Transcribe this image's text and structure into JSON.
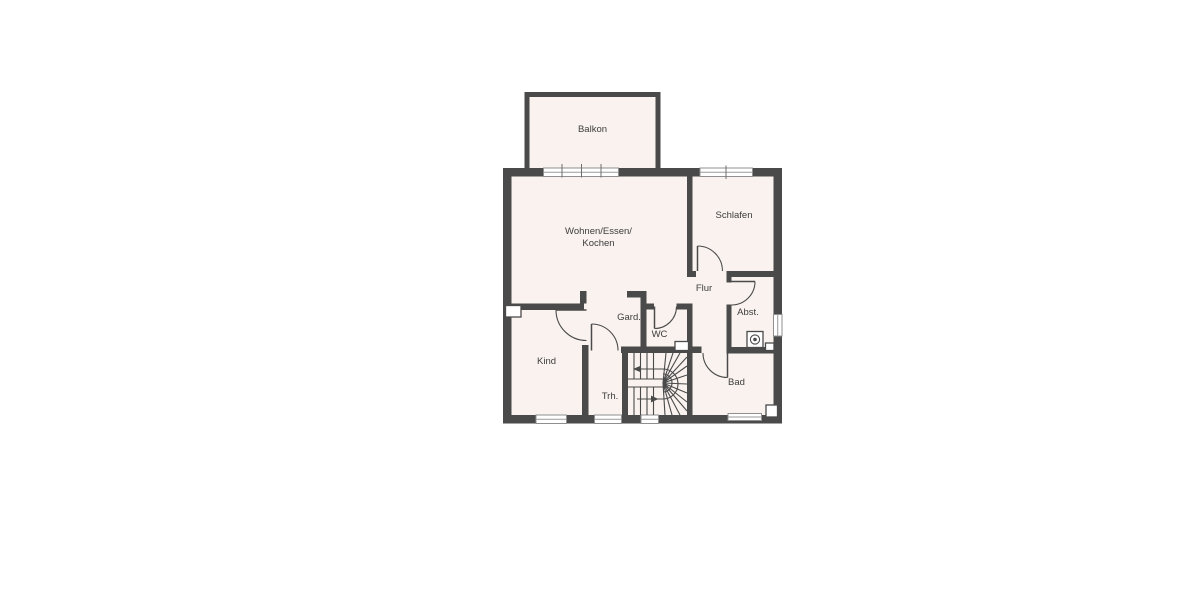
{
  "plan": {
    "title": "floor-plan",
    "rooms": {
      "balkon": {
        "label": "Balkon"
      },
      "wohnen": {
        "label_line1": "Wohnen/Essen/",
        "label_line2": "Kochen"
      },
      "schlafen": {
        "label": "Schlafen"
      },
      "flur": {
        "label": "Flur"
      },
      "gard": {
        "label": "Gard."
      },
      "wc": {
        "label": "WC"
      },
      "abst": {
        "label": "Abst."
      },
      "kind": {
        "label": "Kind"
      },
      "trh": {
        "label": "Trh."
      },
      "bad": {
        "label": "Bad"
      }
    },
    "colors": {
      "wall": "#4a4a4a",
      "room_fill": "#f9f2ef",
      "background": "#ffffff",
      "text": "#3d3d3d"
    }
  }
}
